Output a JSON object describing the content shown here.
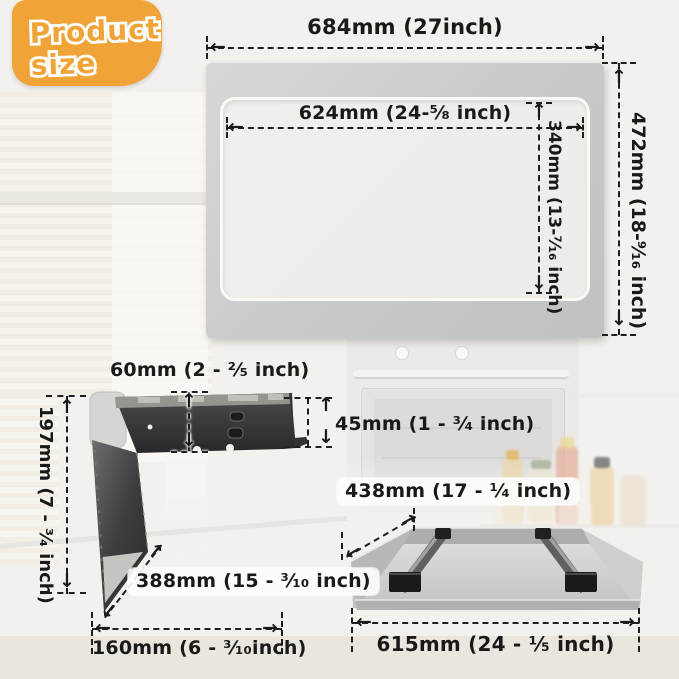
{
  "badge": {
    "line1": "Product",
    "line2": "size"
  },
  "dims": {
    "frame_width": "684mm (27inch)",
    "opening_width": "624mm (24-⁵⁄₈ inch)",
    "opening_height": "340mm (13-⁷⁄₁₆ inch)",
    "frame_height": "472mm (18-⁹⁄₁₆ inch)",
    "bracket_top": "60mm (2 - ²⁄₅ inch)",
    "bracket_side": "197mm (7 - ³⁄₄ inch)",
    "bracket_flange": "45mm (1 - ³⁄₄ inch)",
    "bracket_depth": "388mm (15 - ³⁄₁₀ inch)",
    "bracket_width": "160mm (6 - ³⁄₁₀inch)",
    "tray_depth": "438mm (17 - ¹⁄₄ inch)",
    "tray_width": "615mm (24 - ¹⁄₅ inch)"
  },
  "icons": {
    "arrow_left": "←",
    "arrow_right": "→",
    "arrow_up": "↑",
    "arrow_down": "↓"
  },
  "colors": {
    "badge_bg": "#F0A437",
    "metal_frame": "#C9CBCD",
    "dim_line": "#1F1F1F",
    "vent_slot": "#1B1B1B",
    "bracket_dark": "#2E2E30",
    "tray_metal": "#C2C4C6"
  }
}
